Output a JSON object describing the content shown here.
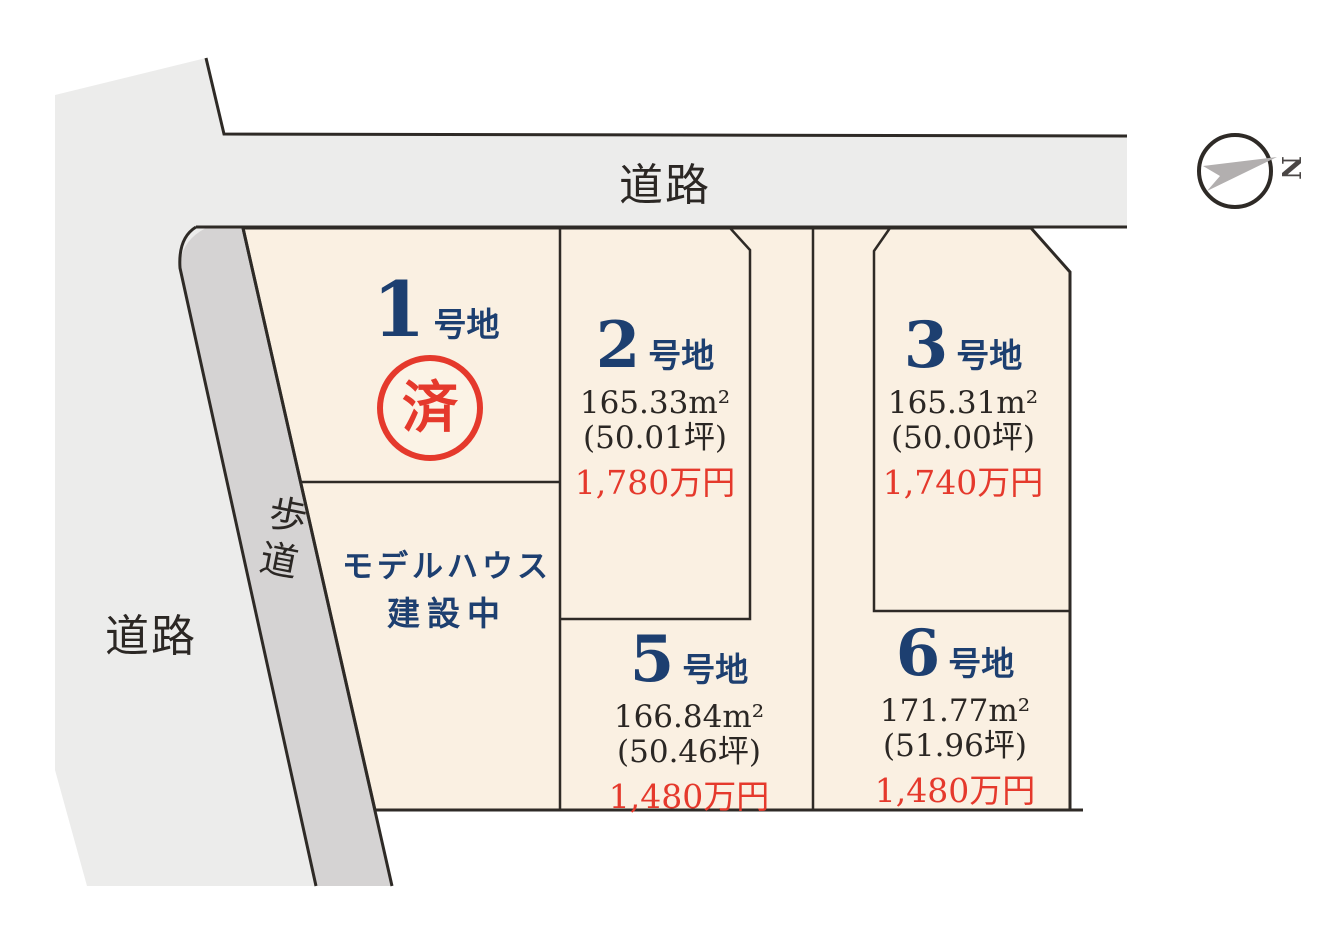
{
  "colors": {
    "road_fill": "#ececeb",
    "sidewalk_fill": "#d5d3d3",
    "lot_fill": "#faf0e2",
    "boundary_line": "#2e2a26",
    "navy_text": "#1d3f70",
    "red_accent": "#e5392c",
    "compass_arrow_gray": "#b2afaf"
  },
  "roads": {
    "top_label": "道路",
    "left_label": "道路",
    "sidewalk_label": "歩道"
  },
  "compass": {
    "letter": "N"
  },
  "model_house": {
    "line1": "モデルハウス",
    "line2": "建設中"
  },
  "lot1": {
    "number": "1",
    "suffix": "号地",
    "sold": "済"
  },
  "lots": [
    {
      "number": "2",
      "suffix": "号地",
      "area": "165.33m²",
      "tsubo": "(50.01坪)",
      "price": "1,780万円"
    },
    {
      "number": "3",
      "suffix": "号地",
      "area": "165.31m²",
      "tsubo": "(50.00坪)",
      "price": "1,740万円"
    },
    {
      "number": "5",
      "suffix": "号地",
      "area": "166.84m²",
      "tsubo": "(50.46坪)",
      "price": "1,480万円"
    },
    {
      "number": "6",
      "suffix": "号地",
      "area": "171.77m²",
      "tsubo": "(51.96坪)",
      "price": "1,480万円"
    }
  ]
}
